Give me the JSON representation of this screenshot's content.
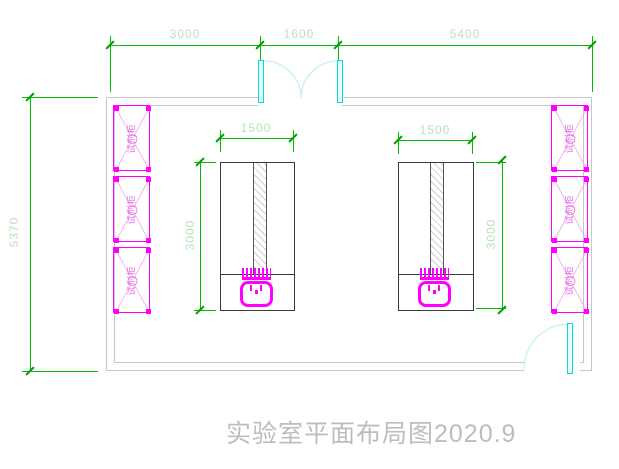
{
  "title": {
    "text": "实验室平面布局图2020.9"
  },
  "dimensions": {
    "top": {
      "seg1": "3000",
      "seg2": "1600",
      "seg3": "5400"
    },
    "left": {
      "total": "5370"
    },
    "bench_left": {
      "width": "1500",
      "depth": "3000"
    },
    "bench_right": {
      "width": "1500",
      "depth": "3000"
    }
  },
  "cabinets": {
    "label": "试剂柜"
  },
  "colors": {
    "dimension_green": "#00bf00",
    "dimension_text_green": "#b9e2b9",
    "cabinet_magenta": "#ff00ff",
    "door_cyan": "#00dede",
    "wall_gray": "#c7c7c7",
    "title_gray": "#bdbdbd"
  }
}
